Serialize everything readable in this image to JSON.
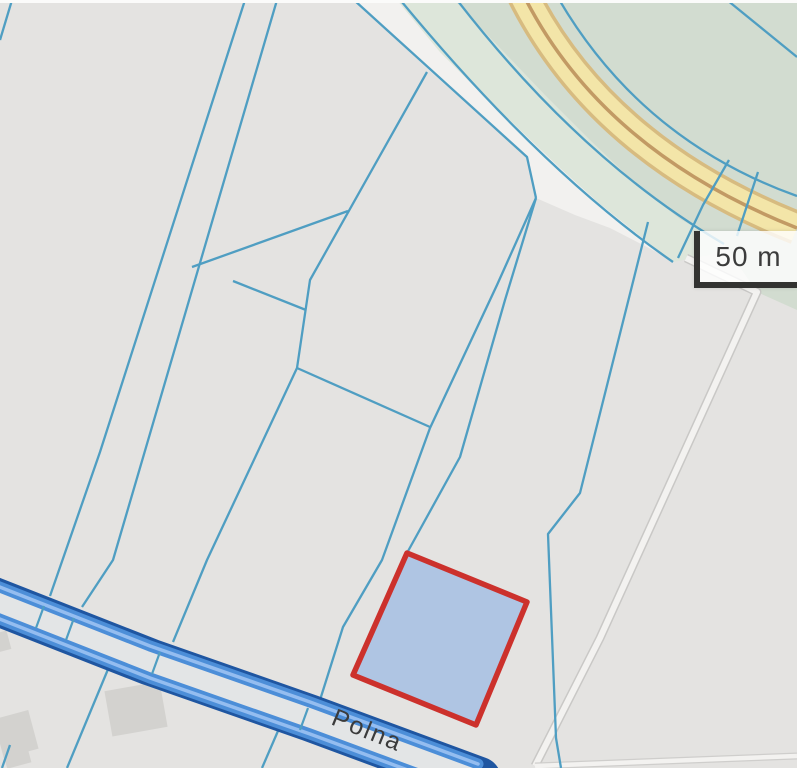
{
  "map": {
    "type": "cadastral-parcel-map",
    "road_label": "Polna",
    "scale_bar": {
      "label": "50 m"
    },
    "selected_parcel": {
      "name": "highlighted-parcel",
      "fill_color": "#a9c2e4",
      "border_color": "#d0302b"
    },
    "colors": {
      "background_gray": "#e4e3e1",
      "parcel_line_teal": "#4d9ec4",
      "greenery": "#d2dcd0",
      "pale_green_strip": "#dde6da",
      "minor_road_white": "#f2f1ef",
      "major_road_yellow": "#f3e5a6",
      "major_road_edge_tan": "#d8bb7e",
      "major_road_center_brown": "#c39a62",
      "highlight_road_blue_dark": "#1e56a4",
      "highlight_road_blue_core": "#4a8edb",
      "highlight_road_gap": "#e3e5e6",
      "building_gray": "#d3d2cf",
      "scalebar_bracket": "#333331",
      "label_text": "#3b3b3b"
    }
  }
}
